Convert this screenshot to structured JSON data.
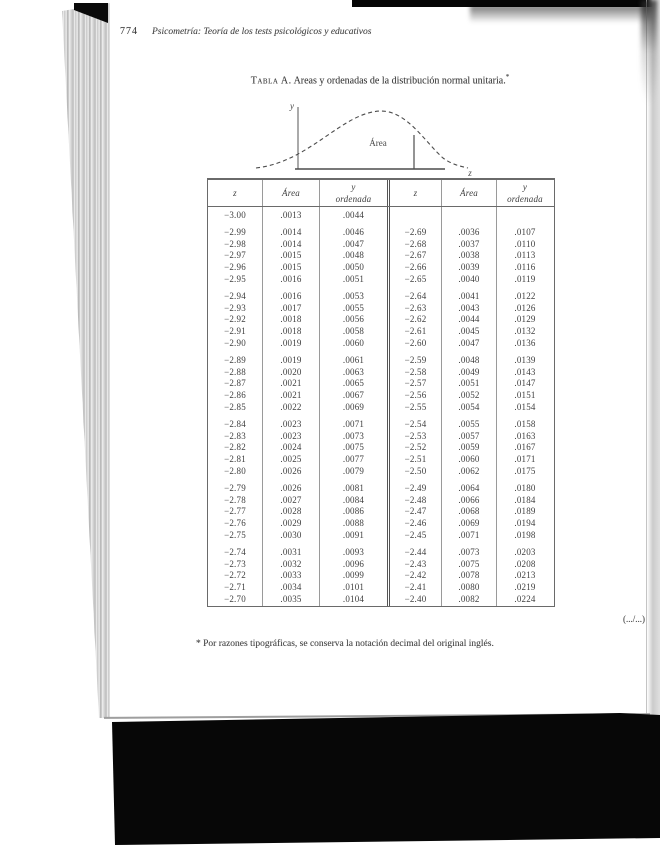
{
  "page": {
    "page_number": "774",
    "running_head": "Psicometría: Teoría de los tests psicológicos y educativos",
    "table_title_label": "Tabla A.",
    "table_title_text": "Areas y ordenadas de la distribución normal unitaria.",
    "table_title_mark": "*",
    "continuation_mark": "(.../...)",
    "footnote": "* Por razones tipográficas, se conserva la notación decimal del original inglés."
  },
  "diagram": {
    "y_axis_label": "y",
    "x_axis_label": "z",
    "area_label": "Área"
  },
  "table": {
    "headers": [
      "z",
      "Área",
      "y\nordenada",
      "z",
      "Área",
      "y\nordenada"
    ],
    "first_row": [
      "−3.00",
      ".0013",
      ".0044",
      "",
      "",
      ""
    ],
    "groups": [
      [
        [
          "−2.99",
          ".0014",
          ".0046",
          "−2.69",
          ".0036",
          ".0107"
        ],
        [
          "−2.98",
          ".0014",
          ".0047",
          "−2.68",
          ".0037",
          ".0110"
        ],
        [
          "−2.97",
          ".0015",
          ".0048",
          "−2.67",
          ".0038",
          ".0113"
        ],
        [
          "−2.96",
          ".0015",
          ".0050",
          "−2.66",
          ".0039",
          ".0116"
        ],
        [
          "−2.95",
          ".0016",
          ".0051",
          "−2.65",
          ".0040",
          ".0119"
        ]
      ],
      [
        [
          "−2.94",
          ".0016",
          ".0053",
          "−2.64",
          ".0041",
          ".0122"
        ],
        [
          "−2.93",
          ".0017",
          ".0055",
          "−2.63",
          ".0043",
          ".0126"
        ],
        [
          "−2.92",
          ".0018",
          ".0056",
          "−2.62",
          ".0044",
          ".0129"
        ],
        [
          "−2.91",
          ".0018",
          ".0058",
          "−2.61",
          ".0045",
          ".0132"
        ],
        [
          "−2.90",
          ".0019",
          ".0060",
          "−2.60",
          ".0047",
          ".0136"
        ]
      ],
      [
        [
          "−2.89",
          ".0019",
          ".0061",
          "−2.59",
          ".0048",
          ".0139"
        ],
        [
          "−2.88",
          ".0020",
          ".0063",
          "−2.58",
          ".0049",
          ".0143"
        ],
        [
          "−2.87",
          ".0021",
          ".0065",
          "−2.57",
          ".0051",
          ".0147"
        ],
        [
          "−2.86",
          ".0021",
          ".0067",
          "−2.56",
          ".0052",
          ".0151"
        ],
        [
          "−2.85",
          ".0022",
          ".0069",
          "−2.55",
          ".0054",
          ".0154"
        ]
      ],
      [
        [
          "−2.84",
          ".0023",
          ".0071",
          "−2.54",
          ".0055",
          ".0158"
        ],
        [
          "−2.83",
          ".0023",
          ".0073",
          "−2.53",
          ".0057",
          ".0163"
        ],
        [
          "−2.82",
          ".0024",
          ".0075",
          "−2.52",
          ".0059",
          ".0167"
        ],
        [
          "−2.81",
          ".0025",
          ".0077",
          "−2.51",
          ".0060",
          ".0171"
        ],
        [
          "−2.80",
          ".0026",
          ".0079",
          "−2.50",
          ".0062",
          ".0175"
        ]
      ],
      [
        [
          "−2.79",
          ".0026",
          ".0081",
          "−2.49",
          ".0064",
          ".0180"
        ],
        [
          "−2.78",
          ".0027",
          ".0084",
          "−2.48",
          ".0066",
          ".0184"
        ],
        [
          "−2.77",
          ".0028",
          ".0086",
          "−2.47",
          ".0068",
          ".0189"
        ],
        [
          "−2.76",
          ".0029",
          ".0088",
          "−2.46",
          ".0069",
          ".0194"
        ],
        [
          "−2.75",
          ".0030",
          ".0091",
          "−2.45",
          ".0071",
          ".0198"
        ]
      ],
      [
        [
          "−2.74",
          ".0031",
          ".0093",
          "−2.44",
          ".0073",
          ".0203"
        ],
        [
          "−2.73",
          ".0032",
          ".0096",
          "−2.43",
          ".0075",
          ".0208"
        ],
        [
          "−2.72",
          ".0033",
          ".0099",
          "−2.42",
          ".0078",
          ".0213"
        ],
        [
          "−2.71",
          ".0034",
          ".0101",
          "−2.41",
          ".0080",
          ".0219"
        ],
        [
          "−2.70",
          ".0035",
          ".0104",
          "−2.40",
          ".0082",
          ".0224"
        ]
      ]
    ]
  },
  "colors": {
    "ink": "#3c3c3c",
    "scan_black": "#070707",
    "rule_light": "#9a9a9a",
    "rule_dark": "#555555"
  }
}
